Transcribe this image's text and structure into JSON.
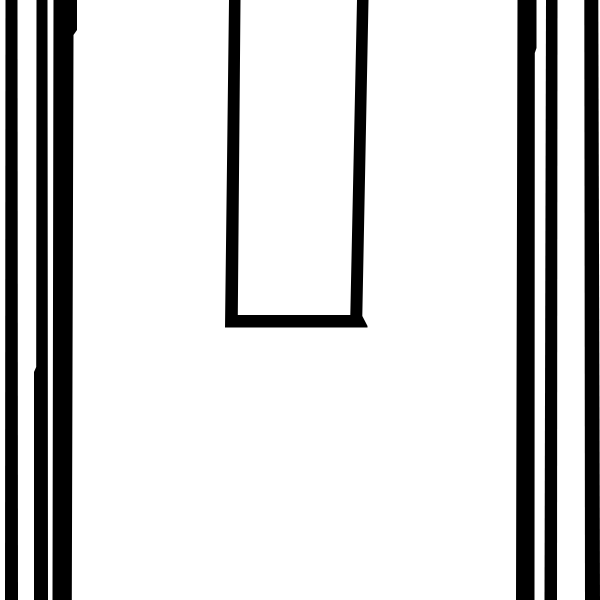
{
  "canvas": {
    "width": 600,
    "height": 600,
    "description": "abstract black-and-white graphic: vertical stripes at left and right edges, tall open-top U outline in upper center"
  },
  "colors": {
    "background": "#ffffff",
    "ink": "#000000"
  },
  "shapes": {
    "left_stripe_1": {
      "points": "5.5,0 17.5,0 18,600 5,600"
    },
    "left_stripe_2": {
      "points": "36.5,0 47.5,0 48,600 34,600 34,372 36.2,367"
    },
    "left_stripe_3": {
      "points": "53.5,0 77,0 77,30 73.5,35 71.8,600 52.5,600"
    },
    "center_u": {
      "d": "M229,0 L240.5,0 L237.8,315 L350.3,315 L357,0 L368.5,0 L362.3,316 L367.5,326 L367.5,327.5 L225,327.5 Z"
    },
    "right_stripe_wide": {
      "points": "517.5,0 536.5,0 536.5,48 534.8,53 534.5,600 516,600"
    },
    "right_stripe_mid": {
      "points": "546,0 557.5,0 557,600 544.5,600"
    },
    "right_stripe_edge": {
      "points": "584.3,0 598.3,0 600,600 585,600"
    }
  }
}
